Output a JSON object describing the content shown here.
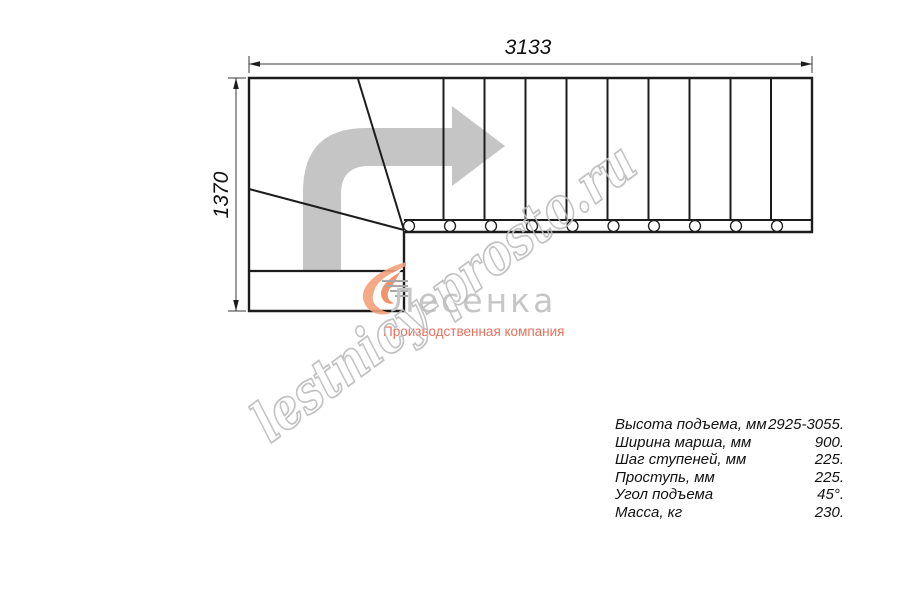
{
  "drawing": {
    "width_label": "3133",
    "height_label": "1370",
    "line_color": "#1c1c1c",
    "arrow_color": "#c5c5c5"
  },
  "logo": {
    "name": "Лесенка",
    "tagline": "Производственная компания",
    "mark_color": "#f5a07a",
    "mark_accent_color": "#ee8153",
    "name_color": "#c6c6c6",
    "tagline_color": "#e4705c"
  },
  "watermark": {
    "text": "lestnicy-prosto.ru",
    "color": "#bcbcbc"
  },
  "specs": {
    "rows": [
      {
        "label": "Высота подъема, мм",
        "value": "2925-3055."
      },
      {
        "label": "Ширина марша, мм",
        "value": "900."
      },
      {
        "label": "Шаг ступеней, мм",
        "value": "225."
      },
      {
        "label": "Проступь, мм",
        "value": "225."
      },
      {
        "label": "Угол подъема",
        "value": "45°."
      },
      {
        "label": "Масса, кг",
        "value": "230."
      }
    ]
  }
}
